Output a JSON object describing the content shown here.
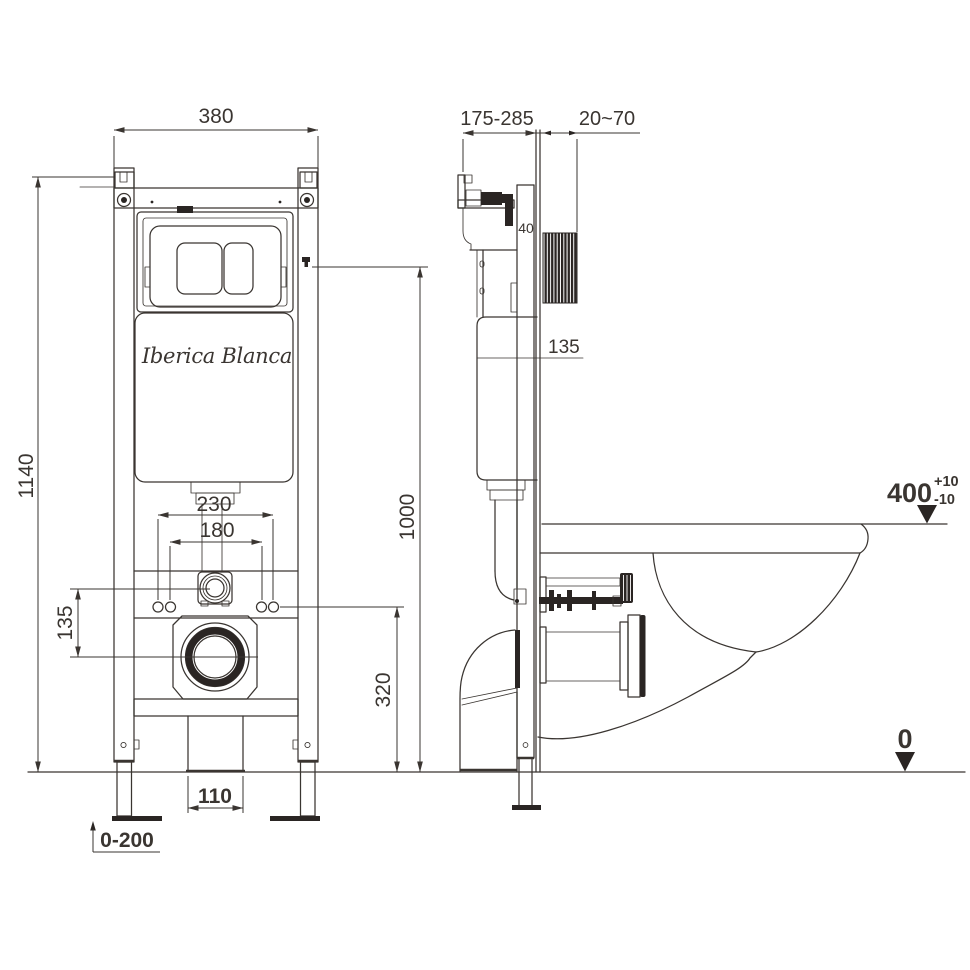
{
  "brand": {
    "logo_text": "Iberica Blanca"
  },
  "front": {
    "frame_width": "380",
    "frame_height": "1140",
    "bolt_spacing_outer": "230",
    "bolt_spacing_inner": "180",
    "connector_drain_offset": "135",
    "drain_center_height": "320",
    "water_inlet_height": "1000",
    "drain_pipe_width": "110",
    "leg_adjust_range": "0-200"
  },
  "side": {
    "frame_depth_range": "175-285",
    "finished_wall_range": "20~70",
    "profile_depth": "40",
    "tank_ref_level": "135",
    "bowl_height": "400",
    "bowl_height_tol_plus": "+10",
    "bowl_height_tol_minus": "-10",
    "floor_level": "0"
  },
  "colors": {
    "ink": "#3a3531",
    "dark_fill": "#2a2523",
    "background": "#ffffff"
  }
}
